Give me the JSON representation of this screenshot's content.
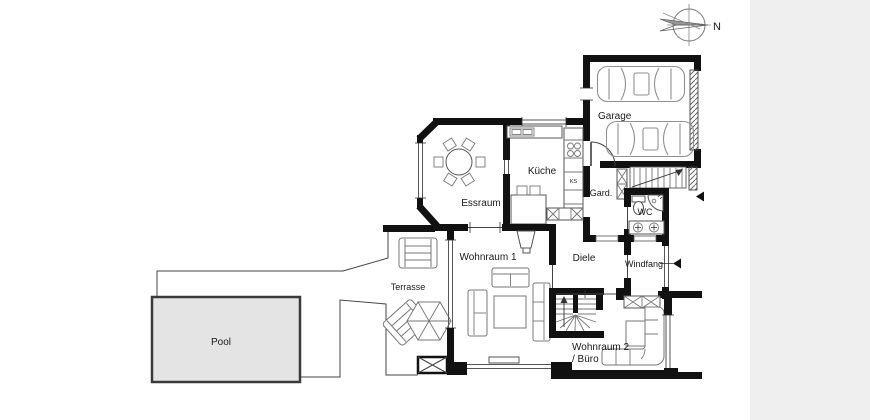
{
  "plan": {
    "type": "residential-floor-plan",
    "language": "de"
  },
  "compass": {
    "label": "N"
  },
  "labels": {
    "garage": "Garage",
    "kueche": "Küche",
    "essraum": "Essraum",
    "gard": "Gard.",
    "wc": "WC",
    "diele": "Diele",
    "windfang": "Windfang",
    "wohnraum1": "Wohnraum 1",
    "wohnraum2": "Wohnraum 2",
    "buero": "/ Büro",
    "terrasse": "Terrasse",
    "pool": "Pool",
    "fridge": "KS"
  },
  "colors": {
    "canvas_background": "#efefef",
    "paper": "#ffffff",
    "wall": "#111111",
    "furniture_outline": "#777777",
    "pool_fill": "#e4e4e4",
    "label_text": "#1a1a1a"
  }
}
